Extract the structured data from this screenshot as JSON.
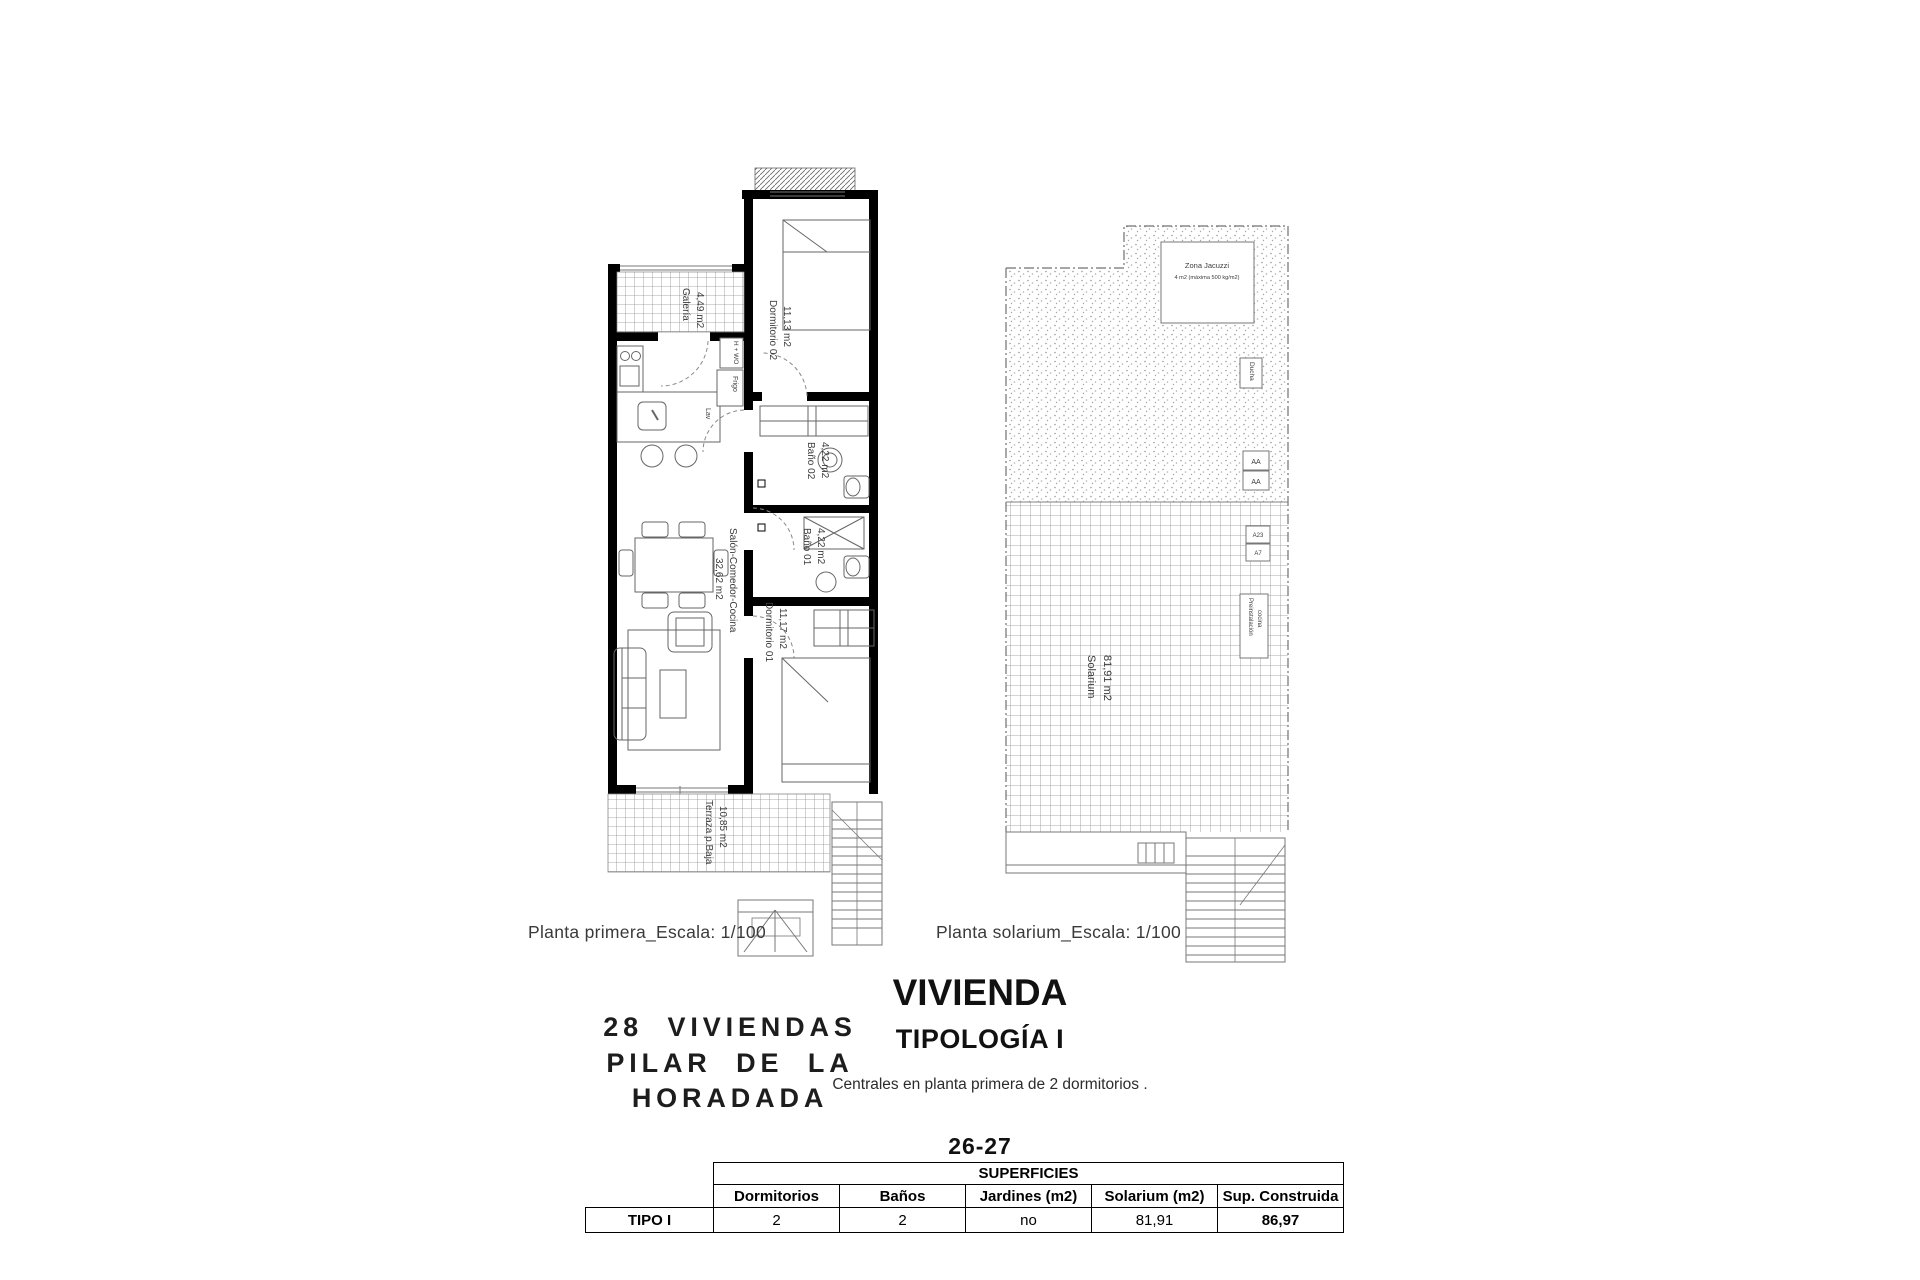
{
  "colors": {
    "wall": "#000000",
    "thin_line": "#777777",
    "label_text": "#3c3c3c"
  },
  "plan_first": {
    "caption": "Planta primera_Escala: 1/100",
    "labels": {
      "galeria_name": "Galería",
      "galeria_area": "4,49 m2",
      "dorm02_name": "Dormitorio 02",
      "dorm02_area": "11,13 m2",
      "bano02_name": "Baño 02",
      "bano02_area": "4,22 m2",
      "bano01_name": "Baño 01",
      "bano01_area": "4,22 m2",
      "salon_name": "Salón-Comedor-Cocina",
      "salon_area": "32,62 m2",
      "dorm01_name": "Dormitorio 01",
      "dorm01_area": "11,17 m2",
      "terraza_name": "Terraza p.Baja",
      "terraza_area": "10,85 m2",
      "hwo": "H + WO",
      "frigo": "Frigo",
      "lav": "Lav"
    }
  },
  "plan_solarium": {
    "caption": "Planta solarium_Escala: 1/100",
    "labels": {
      "jacuzzi_line1": "Zona Jacuzzi",
      "jacuzzi_line2": "4 m2 (máxima 500 kg/m2)",
      "ducha": "Ducha",
      "aa1": "AA",
      "aa2": "AA",
      "unit1": "A23",
      "unit2": "A7",
      "preinst_line1": "Preinstalación",
      "preinst_line2": "cocina",
      "solarium_name": "Solarium",
      "solarium_area": "81,91 m2"
    }
  },
  "title_block": {
    "project_line1": "28 VIVIENDAS",
    "project_line2": "PILAR DE LA",
    "project_line3": "HORADADA",
    "heading": "VIVIENDA",
    "subheading": "TIPOLOGÍA I",
    "description": "Centrales en planta primera de 2 dormitorios .",
    "units": "26-27"
  },
  "table": {
    "title": "SUPERFICIES",
    "row_label": "TIPO I",
    "columns": [
      "Dormitorios",
      "Baños",
      "Jardines (m2)",
      "Solarium (m2)",
      "Sup. Construida"
    ],
    "values": [
      "2",
      "2",
      "no",
      "81,91",
      "86,97"
    ]
  }
}
